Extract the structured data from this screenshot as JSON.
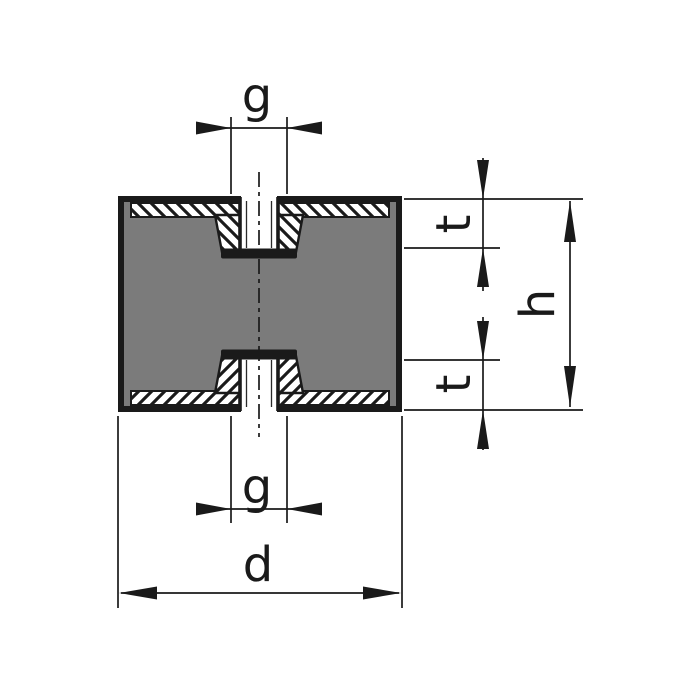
{
  "drawing": {
    "labels": {
      "thread_size_top": "g",
      "thread_size_bottom": "g",
      "thread_depth_top": "t",
      "thread_depth_bottom": "t",
      "height": "h",
      "diameter": "d"
    },
    "colors": {
      "rubber_gray": "#7b7b7b",
      "line_black": "#1a1a1a",
      "metal_white": "#ffffff",
      "background": "#ffffff"
    }
  }
}
